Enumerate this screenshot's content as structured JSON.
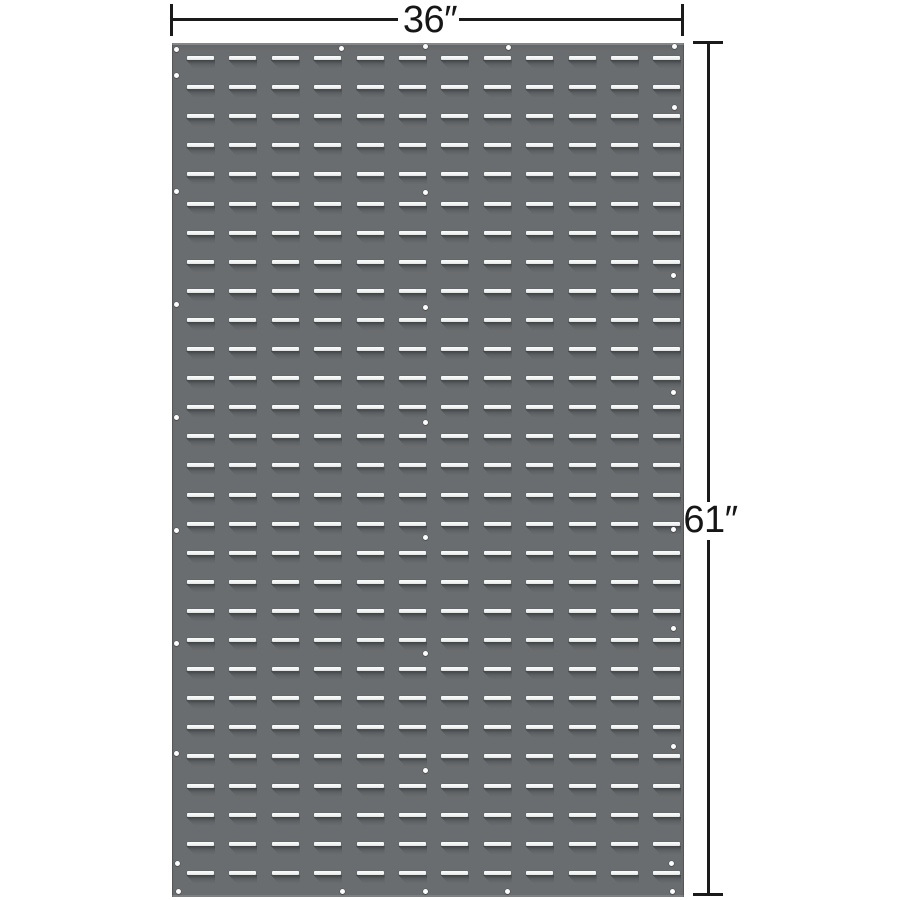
{
  "image": {
    "type": "product-photo",
    "subject": "gray steel louvered panel with dimension callouts",
    "background_color": "#ffffff"
  },
  "dimensions": {
    "width_label": "36″",
    "height_label": "61″",
    "line_color": "#1a1a1a"
  },
  "panel": {
    "base_color": "#6a6d6f",
    "slot_color": "#f3f4f4",
    "lip_shadow_color": "#53575a",
    "rect": {
      "left": 172,
      "top": 43,
      "width": 512,
      "height": 854
    },
    "louver_grid": {
      "columns": 12,
      "rows": 29,
      "origin_x": 187,
      "origin_y": 56,
      "pitch_x": 42.4,
      "pitch_y": 29.1,
      "slot_width": 27,
      "slot_height": 4,
      "lip_height": 9
    },
    "holes": [
      [
        176,
        49
      ],
      [
        341,
        48
      ],
      [
        425,
        46
      ],
      [
        508,
        47
      ],
      [
        674,
        46
      ],
      [
        176,
        75
      ],
      [
        674,
        107
      ],
      [
        176,
        191
      ],
      [
        176,
        304
      ],
      [
        176,
        417
      ],
      [
        176,
        530
      ],
      [
        176,
        643
      ],
      [
        176,
        753
      ],
      [
        425,
        192
      ],
      [
        425,
        307
      ],
      [
        425,
        422
      ],
      [
        425,
        537
      ],
      [
        425,
        653
      ],
      [
        425,
        770
      ],
      [
        673,
        275
      ],
      [
        673,
        392
      ],
      [
        673,
        529
      ],
      [
        673,
        628
      ],
      [
        673,
        746
      ],
      [
        177,
        863
      ],
      [
        671,
        863
      ],
      [
        178,
        891
      ],
      [
        342,
        891
      ],
      [
        425,
        891
      ],
      [
        507,
        891
      ],
      [
        672,
        891
      ]
    ]
  }
}
